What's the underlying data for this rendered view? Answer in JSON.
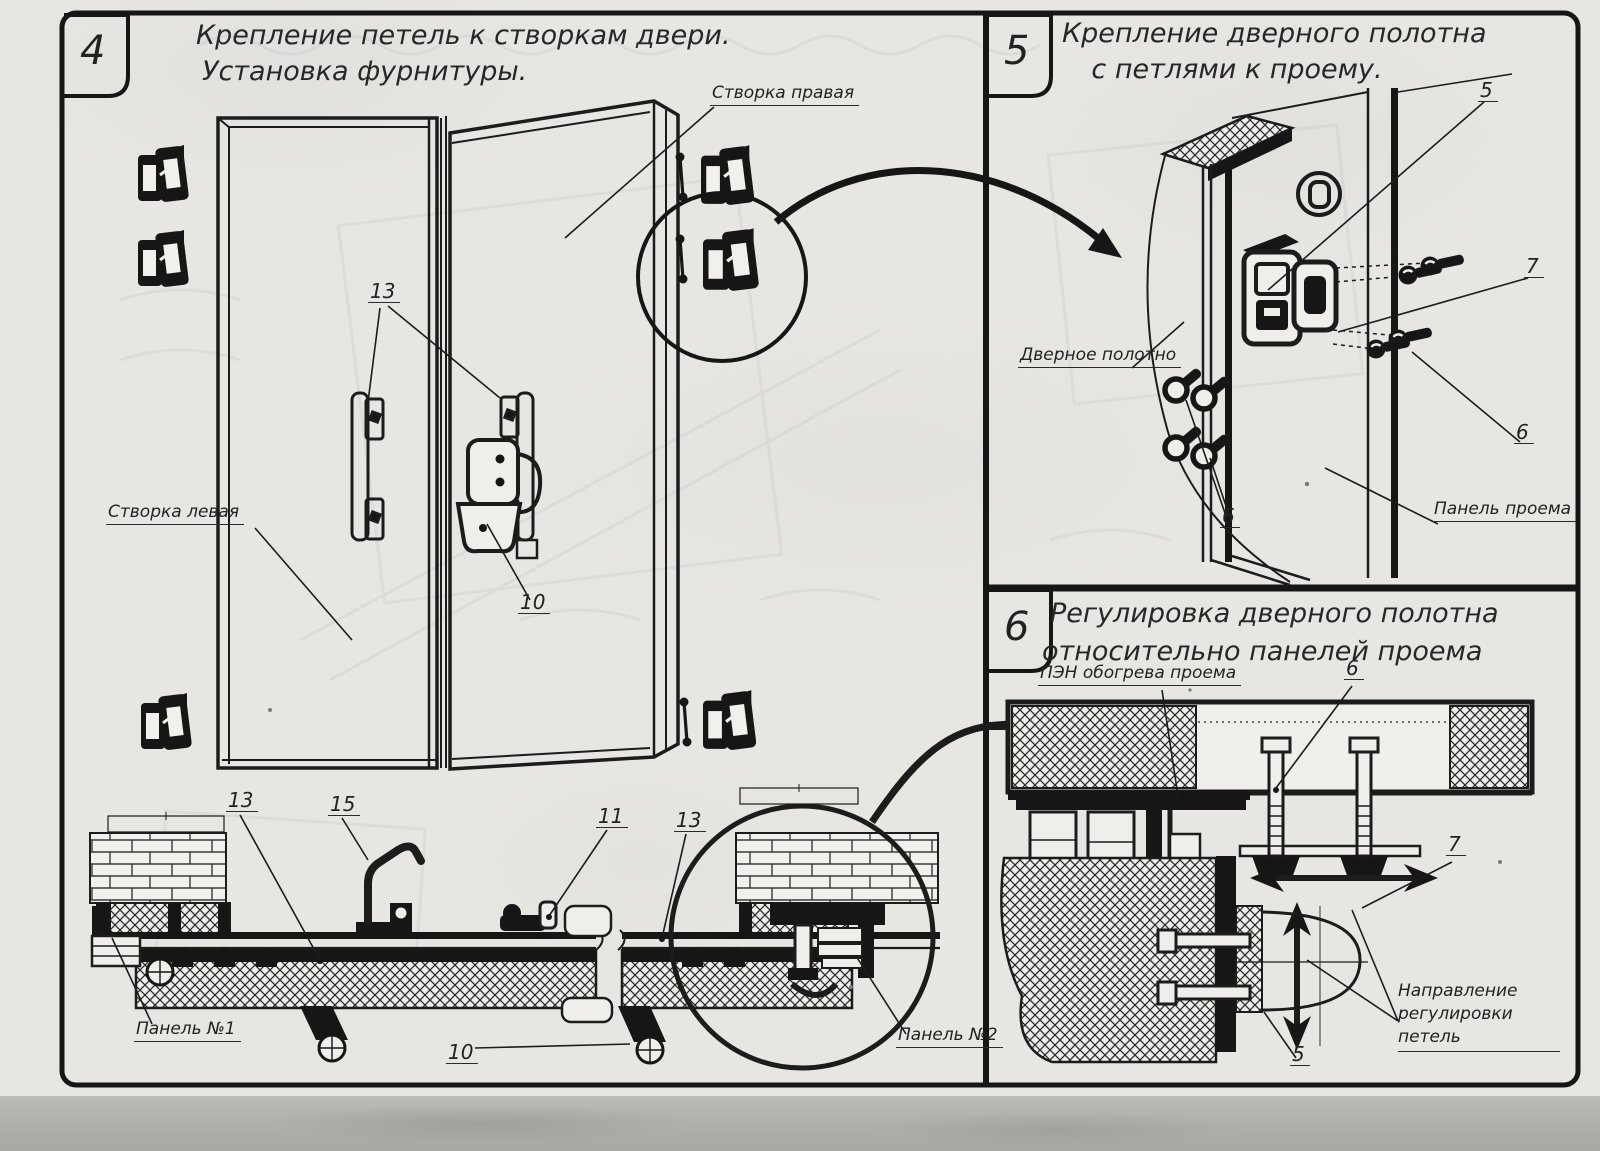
{
  "sheet": {
    "panels": [
      {
        "number": "4",
        "title_lines": [
          "Крепление петель к створкам двери.",
          "Установка фурнитуры."
        ]
      },
      {
        "number": "5",
        "title_lines": [
          "Крепление дверного полотна",
          "с петлями к проему."
        ]
      },
      {
        "number": "6",
        "title_lines": [
          "Регулировка дверного полотна",
          "относительно панелей проема"
        ]
      }
    ],
    "labels": {
      "right_leaf": "Створка правая",
      "left_leaf": "Створка левая",
      "panel_no1": "Панель №1",
      "panel_no2": "Панель №2",
      "door_leaf": "Дверное полотно",
      "opening_panel": "Панель проема",
      "pen_heating": "ПЭН обогрева проема",
      "adjust_direction_line1": "Направление регулировки",
      "adjust_direction_line2": "петель"
    },
    "callouts": {
      "p4_hinge_plates": "13",
      "p4_lock": "10",
      "p4_section_left": "13",
      "p4_hook": "15",
      "p4_mid_hinge": "11",
      "p4_section_mid": "13",
      "p4_section_foot": "10",
      "p5_hinge_top": "5",
      "p5_hinge_mid": "7",
      "p5_screws_right": "6",
      "p5_screws_left": "6",
      "p6_bolt": "6",
      "p6_hinge": "7",
      "p6_bottom": "5"
    },
    "colors": {
      "paper": "#e7e6e2",
      "ink": "#1c1c1c",
      "scan_band": "#b2b1ad"
    }
  }
}
